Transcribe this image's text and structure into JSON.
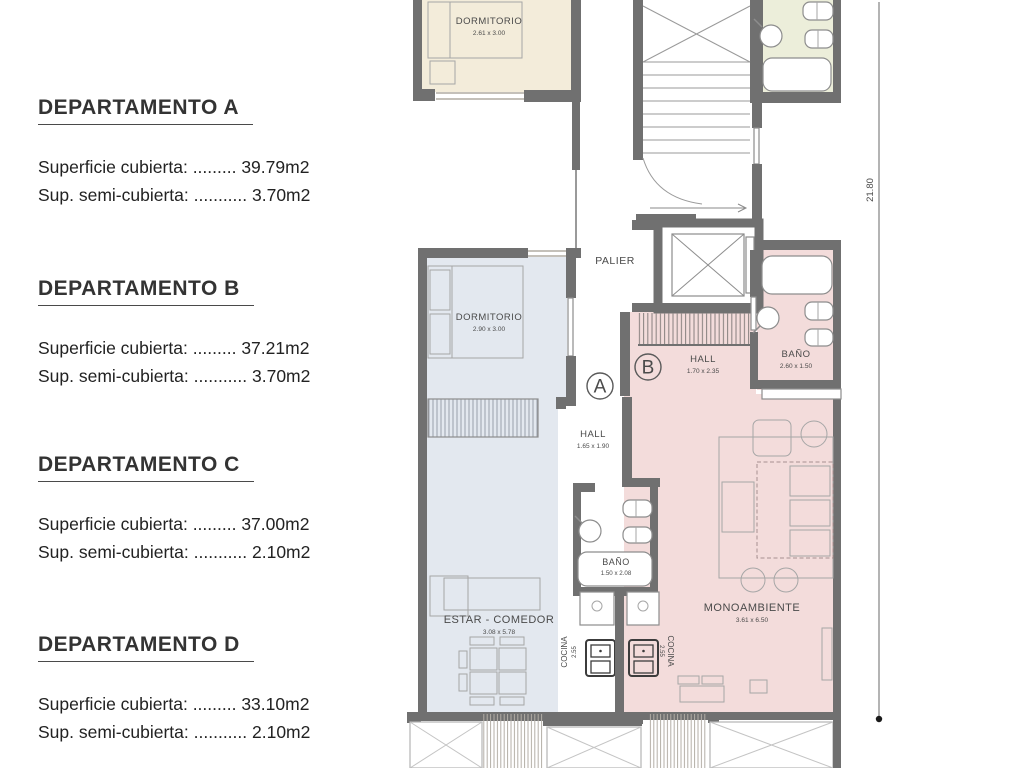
{
  "legend": {
    "departments": [
      {
        "name": "DEPARTAMENTO A",
        "lines": [
          {
            "label": "Superficie cubierta:",
            "dots": ".........",
            "value": "39.79m2"
          },
          {
            "label": "Sup. semi-cubierta:",
            "dots": "...........",
            "value": "3.70m2"
          }
        ]
      },
      {
        "name": "DEPARTAMENTO B",
        "lines": [
          {
            "label": "Superficie cubierta:",
            "dots": ".........",
            "value": "37.21m2"
          },
          {
            "label": "Sup. semi-cubierta:",
            "dots": "...........",
            "value": "3.70m2"
          }
        ]
      },
      {
        "name": "DEPARTAMENTO C",
        "lines": [
          {
            "label": "Superficie cubierta:",
            "dots": ".........",
            "value": "37.00m2"
          },
          {
            "label": "Sup. semi-cubierta:",
            "dots": "...........",
            "value": "2.10m2"
          }
        ]
      },
      {
        "name": "DEPARTAMENTO D",
        "lines": [
          {
            "label": "Superficie cubierta:",
            "dots": ".........",
            "value": "33.10m2"
          },
          {
            "label": "Sup. semi-cubierta:",
            "dots": "...........",
            "value": "2.10m2"
          }
        ]
      }
    ]
  },
  "plan": {
    "rooms": {
      "dorm_top": {
        "name": "DORMITORIO",
        "dims": "2.61 x 3.00"
      },
      "palier": {
        "name": "PALIER"
      },
      "hall_b": {
        "name": "HALL",
        "dims": "1.70 x 2.35"
      },
      "bano_b": {
        "name": "BAÑO",
        "dims": "2.60 x 1.50"
      },
      "dorm_a": {
        "name": "DORMITORIO",
        "dims": "2.90 x 3.00"
      },
      "hall_a": {
        "name": "HALL",
        "dims": "1.65 x 1.90"
      },
      "bano_c": {
        "name": "BAÑO",
        "dims": "1.50 x 2.08"
      },
      "estar": {
        "name": "ESTAR - COMEDOR",
        "dims": "3.08 x 5.78"
      },
      "cocina_c": {
        "name": "COCINA",
        "dims": "2.55"
      },
      "cocina_b": {
        "name": "COCINA",
        "dims": "2.55"
      },
      "mono": {
        "name": "MONOAMBIENTE",
        "dims": "3.61 x 6.50"
      }
    },
    "markers": {
      "a": "A",
      "b": "B"
    },
    "dimension": {
      "total": "21.80"
    },
    "colors": {
      "wall": "#707070",
      "room_beige": "#f3ecda",
      "room_green": "#eceeda",
      "room_blue": "#e3e8ef",
      "room_pink": "#f3dcdb"
    }
  }
}
